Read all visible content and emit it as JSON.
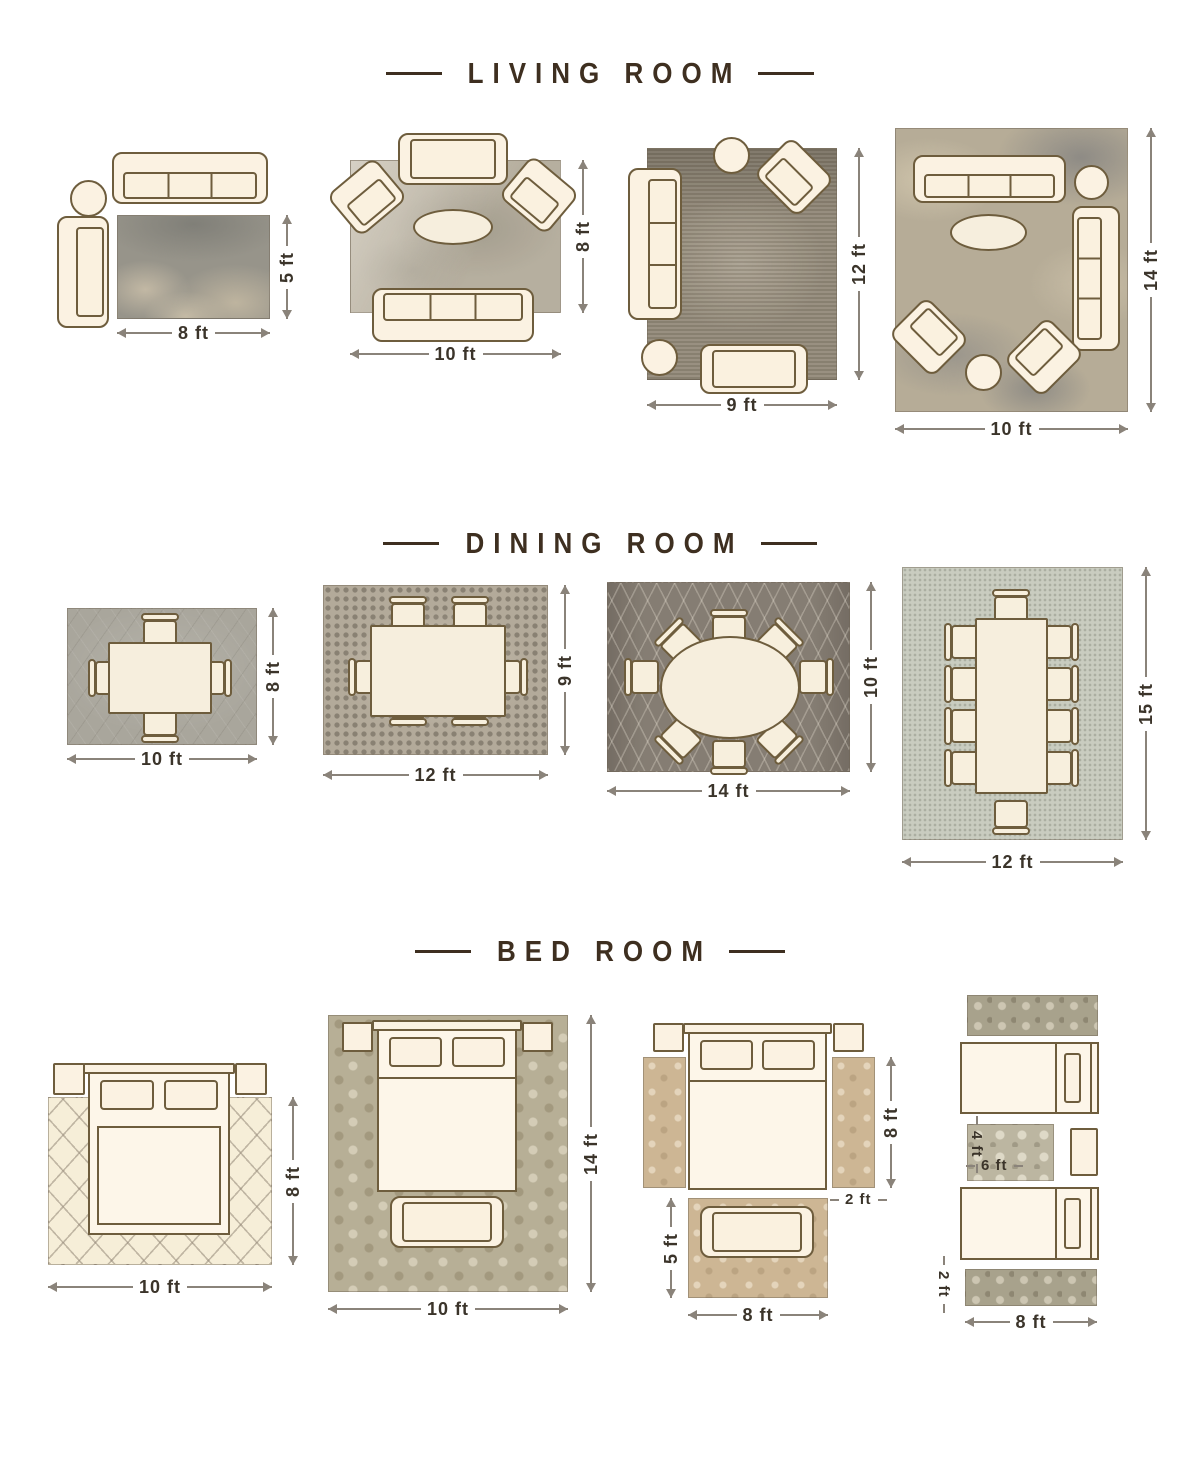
{
  "page": {
    "title": "Rug size guide by room"
  },
  "colors": {
    "background": "#ffffff",
    "title_brown": "#3e2f20",
    "label_dark": "#3b342a",
    "furniture_outline": "#6e5d3d",
    "furniture_fill": "#fbf2e2",
    "dimension_line": "#8a837a"
  },
  "sections": [
    {
      "title": "LIVING ROOM",
      "layouts": [
        {
          "id": "living-8x5",
          "width_label": "8 ft",
          "height_label": "5 ft"
        },
        {
          "id": "living-10x8",
          "width_label": "10 ft",
          "height_label": "8 ft"
        },
        {
          "id": "living-9x12",
          "width_label": "9 ft",
          "height_label": "12 ft"
        },
        {
          "id": "living-10x14",
          "width_label": "10 ft",
          "height_label": "14 ft"
        }
      ]
    },
    {
      "title": "DINING ROOM",
      "layouts": [
        {
          "id": "dining-10x8",
          "width_label": "10 ft",
          "height_label": "8 ft"
        },
        {
          "id": "dining-12x9",
          "width_label": "12 ft",
          "height_label": "9 ft"
        },
        {
          "id": "dining-14x10",
          "width_label": "14 ft",
          "height_label": "10 ft"
        },
        {
          "id": "dining-12x15",
          "width_label": "12 ft",
          "height_label": "15 ft"
        }
      ]
    },
    {
      "title": "BED ROOM",
      "layouts": [
        {
          "id": "bed-10x8",
          "width_label": "10 ft",
          "height_label": "8 ft"
        },
        {
          "id": "bed-10x14",
          "width_label": "10 ft",
          "height_label": "14 ft"
        },
        {
          "id": "bed-side-runners",
          "runner_length_label": "8 ft",
          "runner_width_label": "2 ft",
          "front_rug_height_label": "5 ft",
          "front_rug_width_label": "8 ft"
        },
        {
          "id": "bed-twin-runners",
          "small_rug_height_label": "4 ft",
          "small_rug_width_label": "6 ft",
          "runner_height_label": "2 ft",
          "runner_length_label": "8 ft"
        }
      ]
    }
  ]
}
